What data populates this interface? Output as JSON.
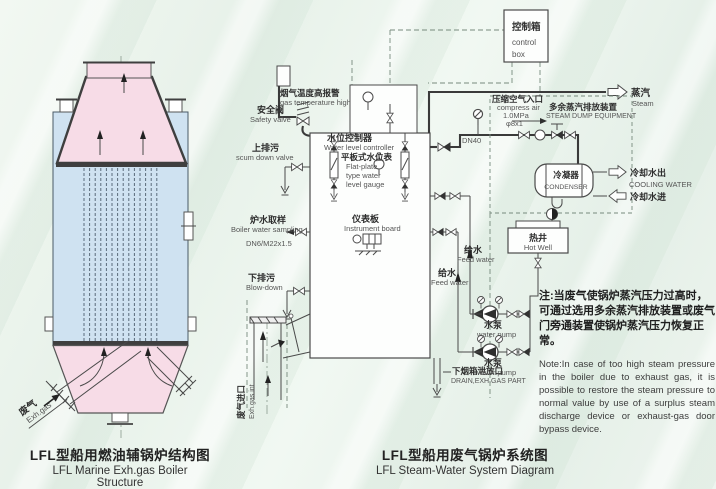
{
  "colors": {
    "pink": "#f7dce7",
    "blue": "#cfe2f1",
    "line": "#4a4a4a"
  },
  "left": {
    "caption_zh": "LFL型船用燃油辅锅炉结构图",
    "caption_en": "LFL Marine Exh.gas Boiler Structure",
    "exh_gas_zh": "废气",
    "exh_gas_en": "Exh.gas"
  },
  "right": {
    "caption_zh": "LFL型船用废气锅炉系统图",
    "caption_en": "LFL Steam-Water System Diagram",
    "labels": {
      "control_box_zh": "控制箱",
      "control_box_en1": "control",
      "control_box_en2": "box",
      "gas_temp_zh": "烟气温度高报警",
      "gas_temp_en": "gas temperature high",
      "safety_zh": "安全阀",
      "safety_en": "Safety valve",
      "wlc_zh": "水位控制器",
      "wlc_en": "Water level controller",
      "scum_zh": "上排污",
      "scum_en": "scum down valve",
      "flat_zh": "平板式水位表",
      "flat_en1": "Flat-plate",
      "flat_en2": "type water",
      "flat_en3": "level gauge",
      "sample_zh": "炉水取样",
      "sample_en": "Boiler water sampling",
      "sample_spec": "DN6/M22x1.5",
      "instr_zh": "仪表板",
      "instr_en": "Instrument board",
      "blow_zh": "下排污",
      "blow_en": "Blow-down",
      "air_zh": "压缩空气入口",
      "air_en": "compress air",
      "air_p": "1.0MPa",
      "air_d": "φ8x1",
      "dump_zh": "多余蒸汽排放装置",
      "dump_en": "STEAM DUMP EQUIPMENT",
      "steam_zh": "蒸汽",
      "steam_en": "Steam",
      "dn40": "DN40",
      "cond_zh": "冷凝器",
      "cond_en": "CONDENSER",
      "cw_out_zh": "冷却水出",
      "cw_en": "COOLING WATER",
      "cw_in_zh": "冷却水进",
      "hw_zh": "热井",
      "hw_en": "Hot Well",
      "feed_zh": "给水",
      "feed_en": "Feed water",
      "pump_zh": "水泵",
      "pump_en": "water pump",
      "drain_zh": "下烟箱泄放口",
      "drain_en": "DRAIN,EXH.GAS PART",
      "exh_in_zh": "废气进口",
      "exh_in_en": "Exh.gas int"
    },
    "note_zh": "注:当废气使锅炉蒸汽压力过高时，可通过选用多余蒸汽排放装置或废气门旁通装置使锅炉蒸汽压力恢复正常。",
    "note_en": "Note:In case of too high steam pressure in the boiler due to exhaust gas, it is possible to restore the steam pressure to normal value by use of a surplus steam discharge device or exhaust-gas door bypass device."
  }
}
